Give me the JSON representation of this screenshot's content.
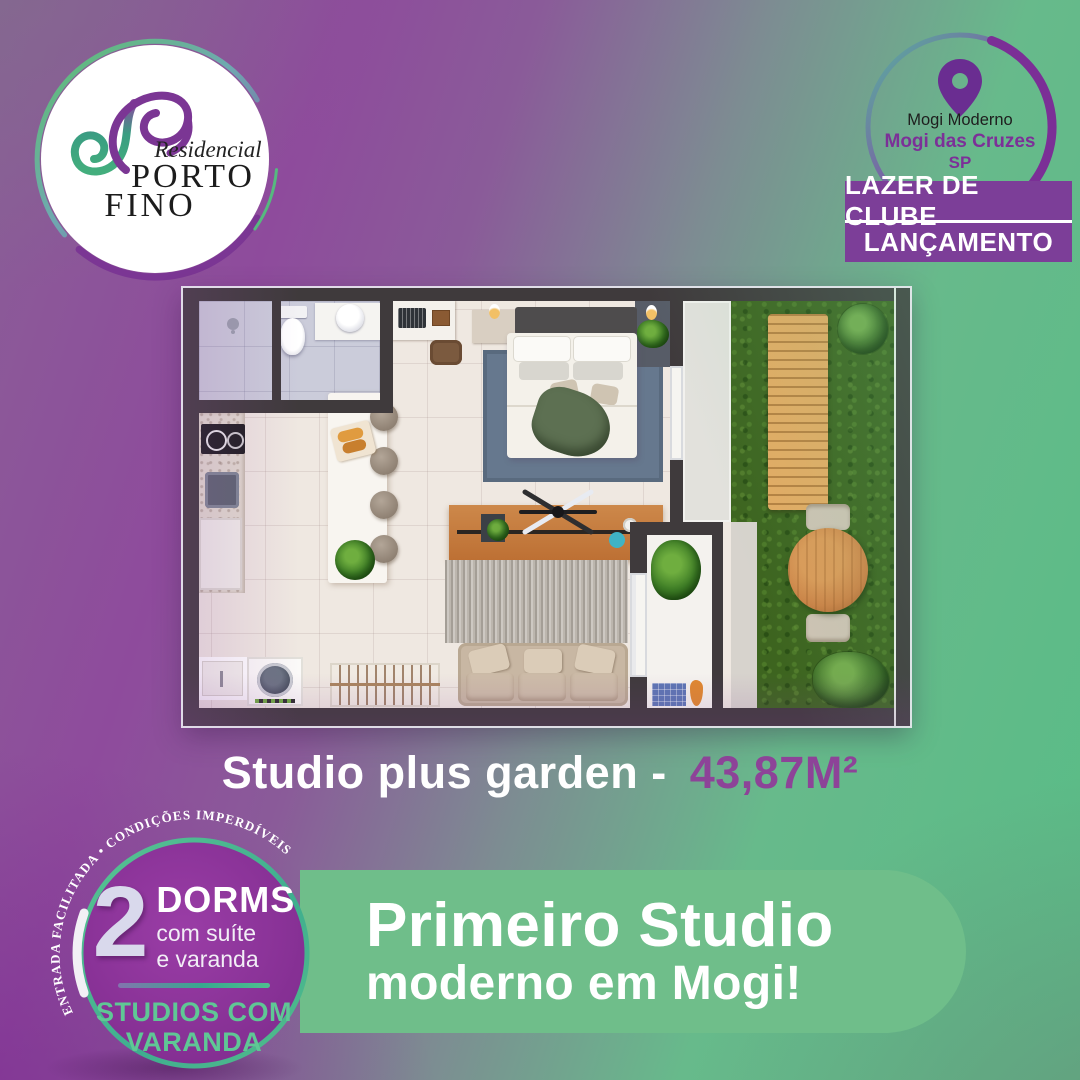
{
  "logo": {
    "script": "Residencial",
    "line1": "PORTO",
    "line2": "FINO"
  },
  "location": {
    "line1": "Mogi Moderno",
    "line2": "Mogi das Cruzes",
    "line3": "SP"
  },
  "ribbons": {
    "first": "LAZER DE CLUBE",
    "second": "LANÇAMENTO"
  },
  "caption": {
    "label": "Studio plus garden -",
    "area": "43,87M²"
  },
  "offer": {
    "curved": "ENTRADA FACILITADA  •  CONDIÇÕES IMPERDÍVEIS",
    "number": "2",
    "unit": "DORMS",
    "detail1": "com suíte",
    "detail2": "e varanda",
    "footer1": "STUDIOS COM",
    "footer2": "VARANDA"
  },
  "headline": {
    "line1": "Primeiro Studio",
    "line2": "moderno em Mogi!"
  },
  "floorplan": {
    "features": [
      "bathroom",
      "kitchen",
      "island-with-stools",
      "bedroom",
      "living-room",
      "laundry",
      "varanda",
      "private-garden",
      "deck",
      "garden-table"
    ]
  },
  "colors": {
    "brand_purple": "#7c3e98",
    "deep_purple": "#6a2d91",
    "badge_purple": "#8a2f94",
    "box_green": "#6fbe8a",
    "accent_green": "#5fc795",
    "area_text_purple": "#8d4398"
  }
}
